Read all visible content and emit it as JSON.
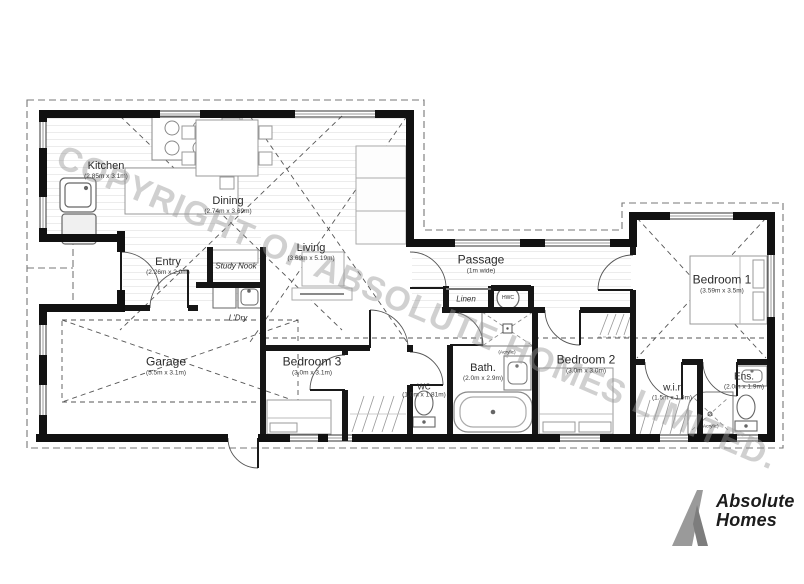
{
  "watermark": "COPYRIGHT OF ABSOLUTE HOMES LIMITED.",
  "logo": {
    "line1": "Absolute",
    "line2": "Homes"
  },
  "rooms": [
    {
      "id": "kitchen",
      "name": "Kitchen",
      "dims": "(2.85m x 3.1m)",
      "x": 106,
      "y": 170,
      "size": 11
    },
    {
      "id": "dining",
      "name": "Dining",
      "dims": "(2.74m x 3.69m)",
      "x": 228,
      "y": 205,
      "size": 11
    },
    {
      "id": "living",
      "name": "Living",
      "dims": "(3.69m x 5.19m)",
      "x": 311,
      "y": 252,
      "size": 11
    },
    {
      "id": "entry",
      "name": "Entry",
      "dims": "(2.26m x 2.0m)",
      "x": 168,
      "y": 266,
      "size": 11
    },
    {
      "id": "garage",
      "name": "Garage",
      "dims": "(5.5m x 3.1m)",
      "x": 166,
      "y": 366,
      "size": 12
    },
    {
      "id": "bedroom3",
      "name": "Bedroom 3",
      "dims": "(3.0m x 3.1m)",
      "x": 312,
      "y": 366,
      "size": 12
    },
    {
      "id": "wc",
      "name": "WC",
      "dims": "(1.0m x 1.81m)",
      "x": 424,
      "y": 391,
      "size": 8
    },
    {
      "id": "bath",
      "name": "Bath.",
      "dims": "(2.0m x 2.9m)",
      "x": 483,
      "y": 372,
      "size": 11
    },
    {
      "id": "passage",
      "name": "Passage",
      "dims": "(1m wide)",
      "x": 481,
      "y": 264,
      "size": 12
    },
    {
      "id": "bedroom2",
      "name": "Bedroom 2",
      "dims": "(3.0m x 3.0m)",
      "x": 586,
      "y": 364,
      "size": 12
    },
    {
      "id": "bedroom1",
      "name": "Bedroom 1",
      "dims": "(3.59m x 3.5m)",
      "x": 722,
      "y": 284,
      "size": 12
    },
    {
      "id": "wir",
      "name": "w.i.r",
      "dims": "(1.5m x 1.9m)",
      "x": 672,
      "y": 392,
      "size": 10
    },
    {
      "id": "ens",
      "name": "Ens.",
      "dims": "(2.0m x 1.9m)",
      "x": 744,
      "y": 381,
      "size": 10
    }
  ],
  "annotations": [
    {
      "id": "study-nook",
      "text": "Study Nook",
      "x": 236,
      "y": 266,
      "size": 8,
      "italic": true
    },
    {
      "id": "ldry",
      "text": "L'Dry",
      "x": 238,
      "y": 318,
      "size": 8,
      "italic": true
    },
    {
      "id": "linen",
      "text": "Linen",
      "x": 466,
      "y": 299,
      "size": 8,
      "italic": true
    },
    {
      "id": "hwc",
      "text": "HWC",
      "x": 508,
      "y": 298,
      "size": 5,
      "italic": false
    },
    {
      "id": "acrylic-bath",
      "text": "(Acrylic)",
      "x": 507,
      "y": 353,
      "size": 4.8,
      "italic": false
    },
    {
      "id": "acrylic-ens",
      "text": "(Acrylic)",
      "x": 710,
      "y": 427,
      "size": 4.8,
      "italic": false
    }
  ]
}
